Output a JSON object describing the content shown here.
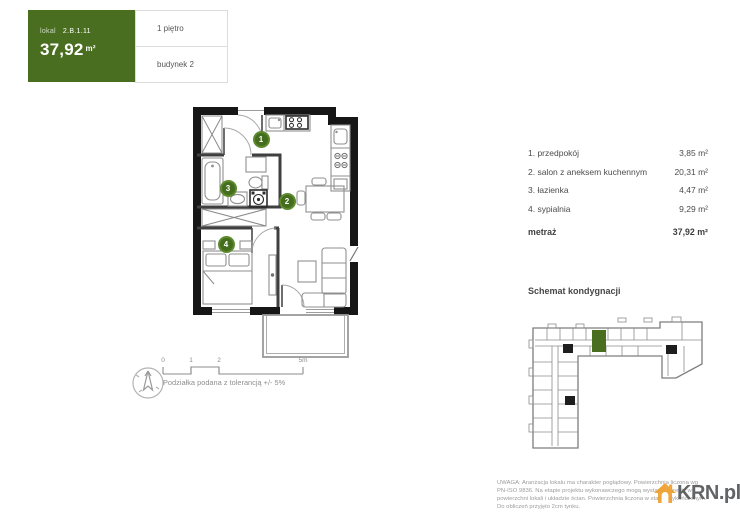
{
  "header": {
    "lokal_label": "lokal",
    "lokal_number": "2.B.1.11",
    "area_value": "37,92",
    "area_unit": "m²",
    "floor": "1 piętro",
    "building": "budynek 2",
    "accent_color": "#4a6e20"
  },
  "plan": {
    "room_badges": [
      {
        "n": "1"
      },
      {
        "n": "2"
      },
      {
        "n": "3"
      },
      {
        "n": "4"
      }
    ],
    "scale": {
      "t0": "0",
      "t1": "1",
      "t2": "2",
      "t5": "5m",
      "note": "Podziałka podana z tolerancją +/- 5%"
    }
  },
  "rooms": {
    "items": [
      {
        "name": "1. przedpokój",
        "area": "3,85 m²"
      },
      {
        "name": "2. salon z aneksem kuchennym",
        "area": "20,31 m²"
      },
      {
        "name": "3. łazienka",
        "area": "4,47 m²"
      },
      {
        "name": "4. sypialnia",
        "area": "9,29 m²"
      }
    ],
    "total_label": "metraż",
    "total_area": "37,92 m²"
  },
  "schematic": {
    "title": "Schemat kondygnacji",
    "highlight_color": "#4a6e20"
  },
  "footer": {
    "disclaimer": "UWAGA: Aranżacja lokalu ma charakter poglądowy. Powierzchnia liczona wg PN-ISO 9836. Na etapie projektu wykonawczego mogą wystąpić korekty w powierzchni lokali i układzie ścian. Powierzchnia liczona w stanie wykończonym. Do obliczeń przyjęto 2cm tynku.",
    "logo_text": "KRN.pl"
  }
}
